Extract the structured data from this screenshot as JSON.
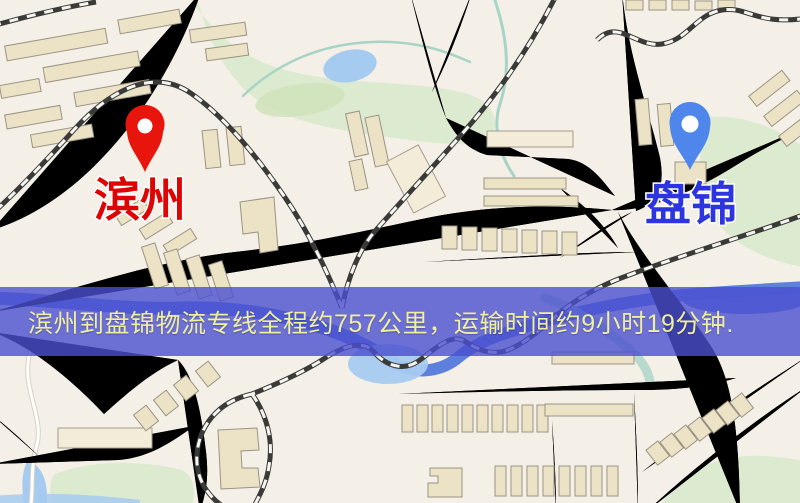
{
  "map": {
    "origin": {
      "name": "滨州",
      "pin_color": "#e8150d",
      "label_color": "#de0403"
    },
    "destination": {
      "name": "盘锦",
      "pin_color": "#4f86ec",
      "label_color": "#2c35df"
    },
    "banner": {
      "text": "滨州到盘锦物流专线全程约757公里，运输时间约9小时19分钟.",
      "bg_color": "rgba(74,79,208,0.8)",
      "text_color": "#efef9e",
      "distance_km": "757",
      "duration_hours": "9",
      "duration_minutes": "19"
    },
    "colors": {
      "road_yellow": "#f7d678",
      "map_background": "#f4efe7",
      "water_blue": "#a6cbf0"
    },
    "icons": {
      "origin_marker": "map-pin-icon",
      "destination_marker": "map-pin-icon"
    }
  }
}
